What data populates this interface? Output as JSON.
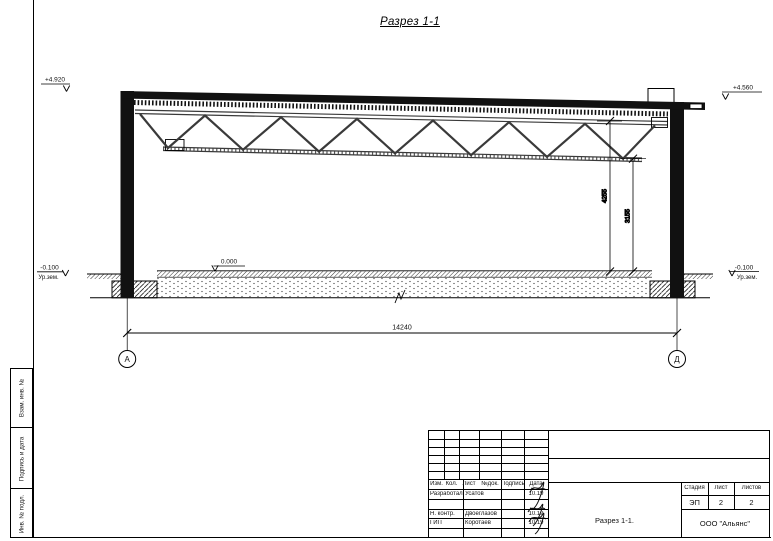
{
  "colors": {
    "ink": "#000000",
    "paper": "#ffffff"
  },
  "drawing_title": "Разрез 1-1",
  "section": {
    "elevations": {
      "roof_left": "+4.920",
      "roof_right": "+4.560",
      "floor": "0.000",
      "ground_left": "-0.100",
      "ground_right": "-0.100",
      "ground_label": "Ур.зем."
    },
    "dimensions": {
      "span": "14240",
      "clear_height": "4255",
      "truss_bottom_height": "3155"
    },
    "axes": {
      "left": "А",
      "right": "Д"
    }
  },
  "side_panel": {
    "boxes": [
      "Взам. инв. №",
      "Подпись и дата",
      "Инв. № подл."
    ]
  },
  "title_block": {
    "header_cols": [
      "Изм.",
      "Кол.",
      "Лист",
      "№док.",
      "Подпись",
      "Дата"
    ],
    "rows": [
      {
        "role": "Разработал",
        "name": "Усатов",
        "date": "10.19"
      },
      {
        "role": "Н. контр.",
        "name": "Двоеглазов",
        "date": "10.19"
      },
      {
        "role": "ГИП",
        "name": "Коротаев",
        "date": "10.19"
      }
    ],
    "stage": {
      "labels": [
        "Стадия",
        "Лист",
        "Листов"
      ],
      "values": [
        "ЭП",
        "2",
        "2"
      ]
    },
    "sheet_name": "Разрез 1-1.",
    "company": "ООО \"Альянс\""
  }
}
